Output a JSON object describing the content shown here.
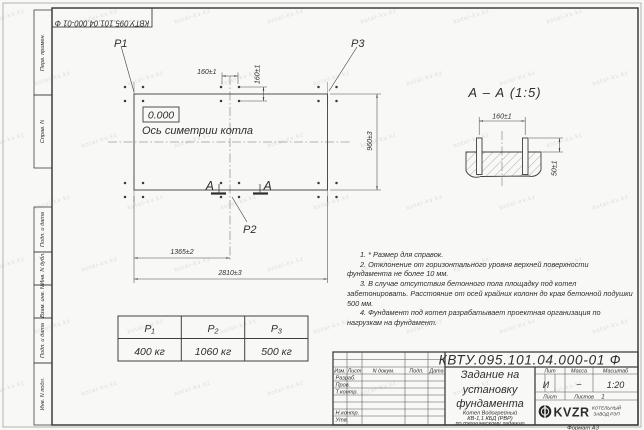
{
  "doc_number": "КВТУ.095.101.04.000-01 Ф",
  "watermark": {
    "text": "kotel-kv.kz"
  },
  "side_stamps": {
    "perv_primen": "Перв. примен.",
    "sprav_n": "Справ. N",
    "podp_data_1": "Подп. и дата",
    "inv_n_dubl": "Инв. N дубл.",
    "vzam_inv_n": "Взам. инв. N",
    "podp_data_2": "Подп. и дата",
    "inv_n_podl": "Инв. N подл."
  },
  "plan": {
    "p1_label": "P1",
    "p2_label": "P2",
    "p3_label": "P3",
    "elevation": "0.000",
    "axis_label": "Ось симетрии котла",
    "dim_bolt_horizontal": "160±1",
    "dim_bolt_vertical": "160±1",
    "dim_height": "960±3",
    "dim_mid": "1365±2",
    "dim_total": "2810±3",
    "section_letter_left": "А",
    "section_letter_right": "А"
  },
  "section_view": {
    "title": "А – А (1:5)",
    "dim_bolt_spacing": "160±1",
    "dim_protrusion": "50±1"
  },
  "notes": {
    "items": [
      "1. * Размер для справок.",
      "2. Отклонение от горизонтального уровня верхней поверхности фундамента не более 10 мм.",
      "3. В случае отсутствия бетонного пола площадку под котел забетонировать. Расстояние от осей крайних колонн до края бетонной подушки 500 мм.",
      "4. Фундамент под котел разрабатывает проектная организация по нагрузкам на фундамент."
    ]
  },
  "load_table": {
    "headers": [
      "P₁",
      "P₂",
      "P₃"
    ],
    "values": [
      "400 кг",
      "1060 кг",
      "500 кг"
    ]
  },
  "title_block": {
    "title_line1": "Задание на",
    "title_line2": "установку",
    "title_line3": "фундамента",
    "subtitle_line1": "Котел Водогрейный",
    "subtitle_line2": "КВ-1,1 КБД (РВР)",
    "subtitle_line3": "по техническому заданию",
    "col_izm": "Изм.",
    "col_list": "Лист",
    "col_n_dokum": "N докум.",
    "col_podp": "Подп.",
    "col_data": "Дата",
    "row_razrab": "Разраб.",
    "row_prov": "Пров.",
    "row_tkontr": "Т.контр.",
    "row_nkontr": "Н.контр.",
    "row_utv": "Утв.",
    "lit_header": "Лит",
    "massa_header": "Масса",
    "masshtab_header": "Масштаб",
    "lit_value": "И",
    "massa_value": "–",
    "masshtab_value": "1:20",
    "list_label": "Лист",
    "listov_label": "Листов",
    "listov_value": "1",
    "logo_text": "KVZR",
    "company_line1": "КОТЕЛЬНЫЙ",
    "company_line2": "ЗАВОД РЭП",
    "format_label": "Формат А3"
  },
  "colors": {
    "line": "#3f3f3f",
    "paper": "#f8f8f6",
    "watermark": "#c7c7c1"
  }
}
